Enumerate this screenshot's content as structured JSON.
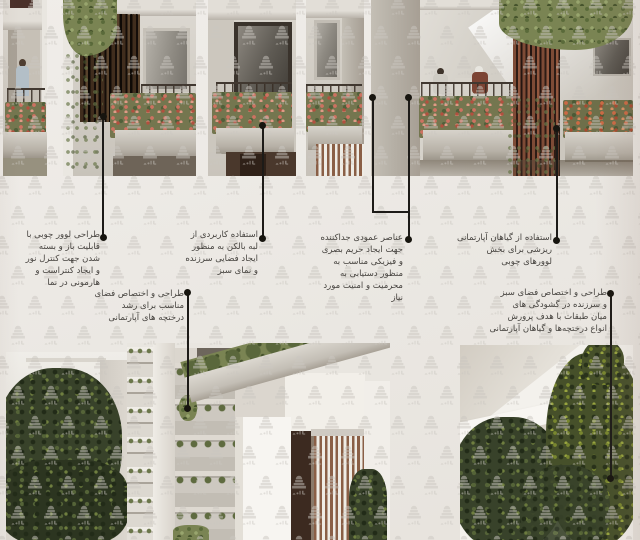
{
  "poster": {
    "colors": {
      "paper": "#ece9e5",
      "ink": "#1d1b18",
      "text": "#45423e",
      "watermark": "#cbc7c1"
    },
    "watermark_icon": "tiered-dome-building-logo"
  },
  "annotations": {
    "louver": {
      "lines": [
        "طراحی لوور چوبی با",
        "قابلیت باز و بسته",
        "شدن جهت کنترل نور",
        "و ایجاد کنتراست و",
        "هارمونی در نما"
      ]
    },
    "balcony_edge": {
      "lines": [
        "استفاده کاربردی از",
        "لبه بالکن به منظور",
        "ایجاد فضایی سرزنده",
        "و نمای سبز"
      ]
    },
    "vertical_elements": {
      "lines": [
        "عناصر عمودی جداکننده",
        "جهت ایجاد حریم بصری",
        "و فیزیکی مناسب به",
        "منظور دستیابی به",
        "محرمیت و امنیت مورد",
        "نیاز"
      ]
    },
    "hanging_plants": {
      "lines": [
        "استفاده از گیاهان آپارتمانی",
        "ریزشی برای بخش",
        "لوورهای چوبی"
      ]
    },
    "floor_openings": {
      "lines": [
        "طراحی و اختصاص فضای سبز",
        "و سرزنده در گشودگی های",
        "میان طبقات با هدف پرورش",
        "انواع درختچه‌ها و گیاهان آپارتمانی"
      ]
    },
    "shrub_space": {
      "lines": [
        "طراحی و اختصاص فضای",
        "مناسب برای رشد",
        "درختچه های آپارتمانی"
      ]
    }
  }
}
